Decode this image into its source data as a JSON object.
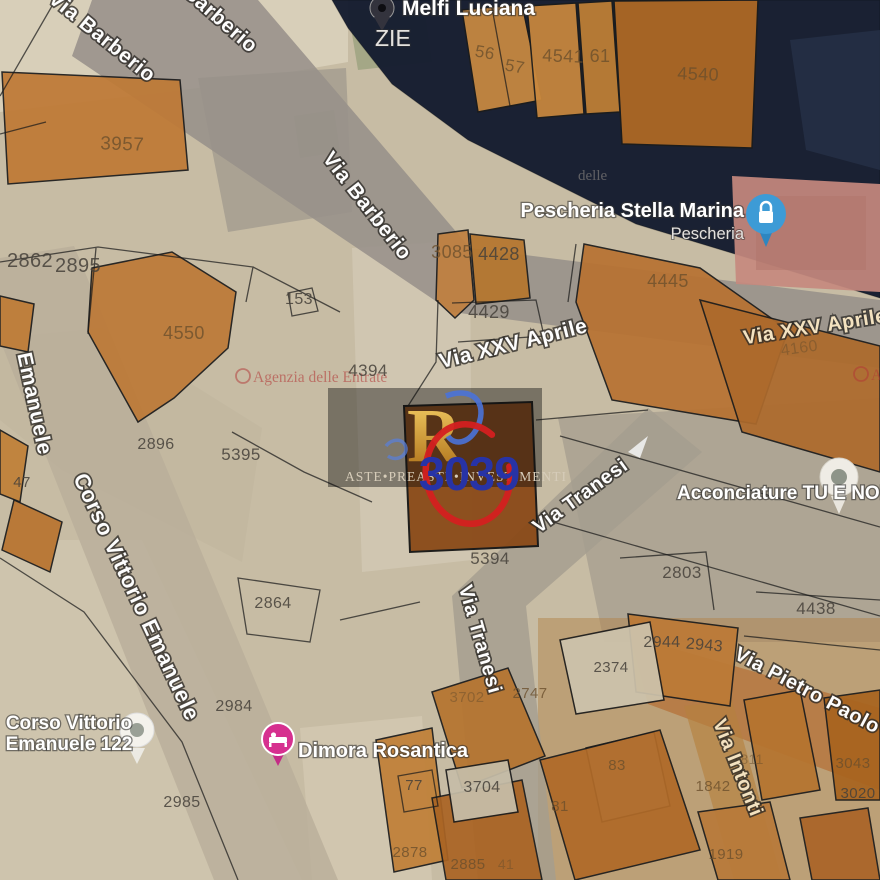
{
  "streets": [
    {
      "label": "Via Barberio"
    },
    {
      "label": "Barberio"
    },
    {
      "label": "Via Barberio"
    },
    {
      "label": "Via XXV Aprile"
    },
    {
      "label": "Via XXV Aprile"
    },
    {
      "label": "Via Tranesi"
    },
    {
      "label": "Via Tranesi"
    },
    {
      "label": "Corso Vittorio Emanuele"
    },
    {
      "label": "Emanuele"
    },
    {
      "label": "Via Pietro Paolo Parz"
    },
    {
      "label": "Via Intonti"
    }
  ],
  "pois": [
    {
      "name": "Melfi Luciana",
      "icon": "location-pin-icon"
    },
    {
      "name": "ZIE"
    },
    {
      "name": "Pescheria Stella Marina",
      "subtitle": "Pescheria",
      "icon": "lock-pin-icon"
    },
    {
      "name": "Acconciature TU E NOI",
      "icon": "location-pin-icon"
    },
    {
      "line1": "Corso Vittorio",
      "line2": "Emanuele 122",
      "icon": "location-pin-icon"
    },
    {
      "name": "Dimora Rosantica",
      "icon": "bed-pin-icon"
    }
  ],
  "parcels": [
    "3957",
    "56",
    "57",
    "4541",
    "61",
    "4540",
    "2862",
    "2895",
    "153",
    "3085",
    "4428",
    "4429",
    "4445",
    "4160",
    "4394",
    "5395",
    "2896",
    "47",
    "4550",
    "5394",
    "2803",
    "4438",
    "2944",
    "2943",
    "2864",
    "2984",
    "2985",
    "2374",
    "2747",
    "3702",
    "77",
    "3704",
    "83",
    "81",
    "2878",
    "2885",
    "41",
    "1811",
    "1842",
    "3043",
    "3020",
    "1919"
  ],
  "watermarks": {
    "agency": "Agenzia delle Entrate",
    "agency_partial": "delle",
    "agency_partial_right": "Agenzia",
    "brand": "ASTE•PREASTE•INVESTIMENTI",
    "brand_logo_letter": "R",
    "lot_number": "3039"
  },
  "colors": {
    "highlight_circle_red": "#d42020",
    "lot_number_blue": "#2733a6",
    "building_orange": "#c07a35",
    "subject_building_brown": "#8a4a18",
    "overlay_navy": "#151d30",
    "pescheria_pin_blue": "#3d9bd6",
    "dimora_pin_pink": "#d6308f",
    "agency_watermark_red": "#b23333"
  }
}
